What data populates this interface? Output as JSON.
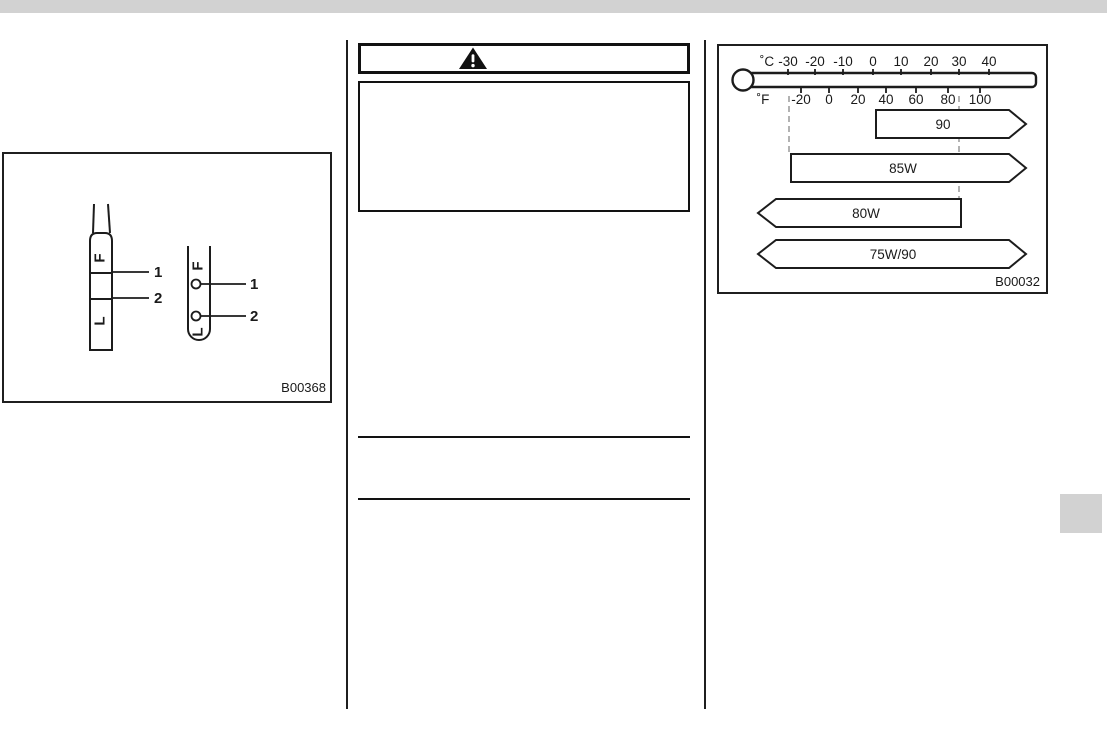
{
  "page": {
    "top_bar_color": "#d2d2d2",
    "edge_tab_color": "#d2d2d2"
  },
  "warning_box": {
    "icon": "warning-triangle"
  },
  "figure_b00368": {
    "code": "B00368",
    "blade_dipstick": {
      "full_mark": "F",
      "low_mark": "L",
      "callout_full": "1",
      "callout_low": "2"
    },
    "tube_dipstick": {
      "full_mark": "F",
      "low_mark": "L",
      "callout_full": "1",
      "callout_low": "2"
    }
  },
  "chart_data": {
    "type": "range-bar",
    "description": "Gear oil viscosity grades vs outside temperature",
    "figure_code": "B00032",
    "celsius": {
      "unit": "˚C",
      "ticks": [
        "-30",
        "-20",
        "-10",
        "0",
        "10",
        "20",
        "30",
        "40"
      ]
    },
    "fahrenheit": {
      "unit": "˚F",
      "ticks": [
        "-20",
        "0",
        "20",
        "40",
        "60",
        "80",
        "100"
      ]
    },
    "series": [
      {
        "name": "90",
        "range_c": [
          0,
          null
        ],
        "arrow_left": false,
        "arrow_right": true
      },
      {
        "name": "85W",
        "range_c": [
          -30,
          null
        ],
        "arrow_left": false,
        "arrow_right": true
      },
      {
        "name": "80W",
        "range_c": [
          null,
          30
        ],
        "arrow_left": true,
        "arrow_right": false
      },
      {
        "name": "75W/90",
        "range_c": [
          null,
          null
        ],
        "arrow_left": true,
        "arrow_right": true
      }
    ],
    "dashed_guides_c": [
      -30,
      30
    ],
    "legend_position": "none",
    "grid": "dashed-guides-only"
  }
}
